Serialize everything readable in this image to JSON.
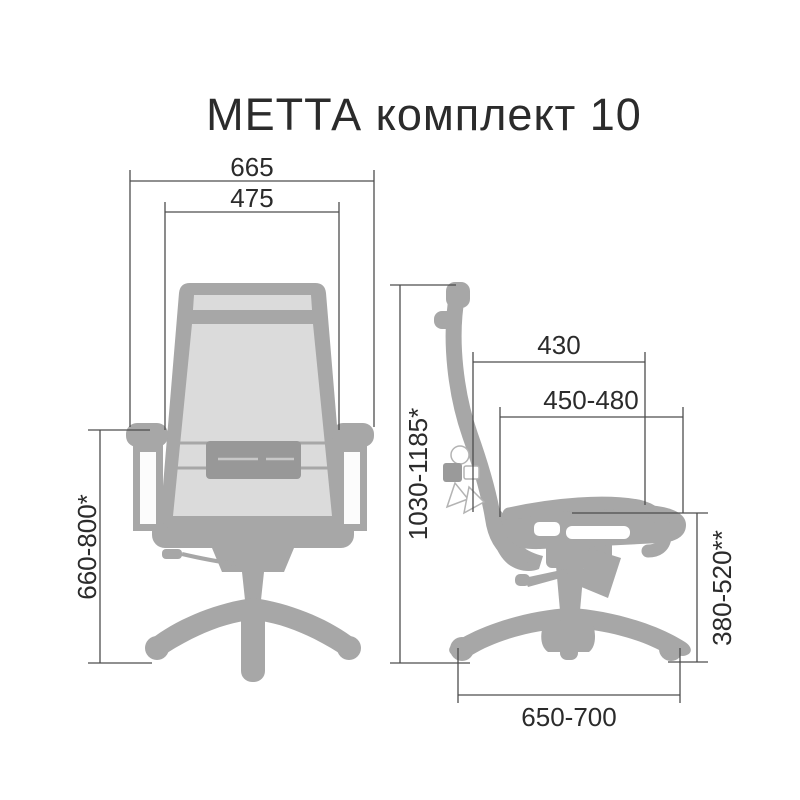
{
  "title": "МЕТТА комплект 10",
  "front_view": {
    "label": "front-view-of-chair",
    "dimensions": {
      "outer_width": "665",
      "inner_width": "475",
      "armrest_height": "660-800*"
    }
  },
  "side_view": {
    "label": "side-view-of-chair",
    "dimensions": {
      "backrest_width": "430",
      "seat_depth": "450-480",
      "overall_height": "1030-1185*",
      "seat_height": "380-520**",
      "base_diameter": "650-700"
    }
  },
  "colors": {
    "chair_gray": "#a7a7a7",
    "mesh_gray": "#dbdbdb",
    "lumbar_gray": "#989898",
    "dimension_line": "#4d4d4d",
    "text": "#2b2b2b",
    "background": "#ffffff"
  }
}
